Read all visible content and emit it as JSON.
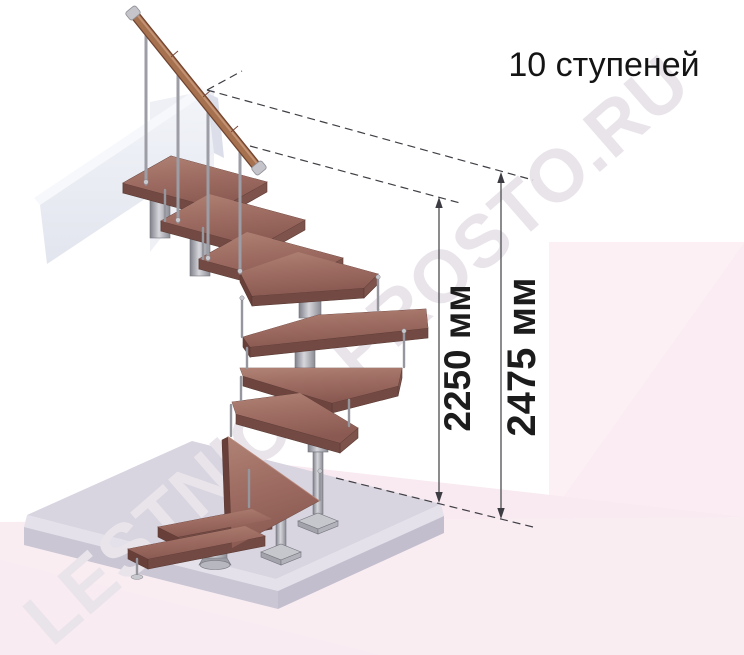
{
  "title": "10 ступеней",
  "watermark": "LESTNICA-PROSTO.RU",
  "dimensions": {
    "stair_height_label": "2250 мм",
    "total_height_label": "2475 мм"
  },
  "scene": {
    "steps_shown": 10,
    "object": "modular-staircase-180-turn"
  },
  "colors": {
    "wood_top": "#9c6a60",
    "wood_side": "#734a43",
    "metal": "#a9a9b0",
    "handrail_wood": "#a5714f",
    "floor_slab": "#d8d4e0",
    "backdrop_pink": "#f9edf2",
    "dimension_line": "#4d4d52",
    "text": "#141414"
  }
}
